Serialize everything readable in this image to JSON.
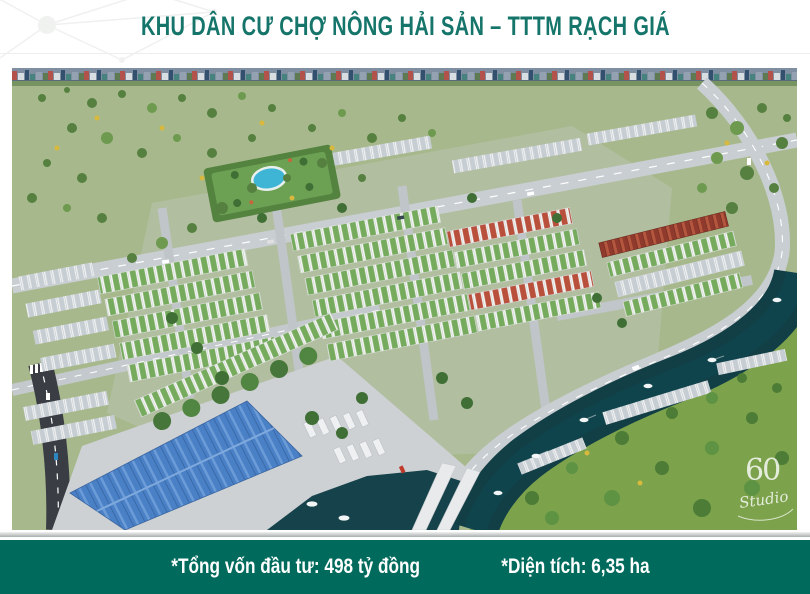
{
  "header": {
    "title": "KHU DÂN CƯ CHỢ NÔNG HẢI SẢN – TTTM RẠCH GIÁ"
  },
  "footer": {
    "investment": "*Tổng vốn đầu tư: 498 tỷ đồng",
    "area": "*Diện tích: 6,35 ha"
  },
  "render": {
    "watermark_number": "60",
    "watermark_word": "Studio"
  },
  "colors": {
    "title_teal": "#15756a",
    "footer_bar_teal": "#006b5c",
    "river_water": "#123e46",
    "field_green": "#7ca24c",
    "market_roof_blue": "#4a80c6"
  }
}
